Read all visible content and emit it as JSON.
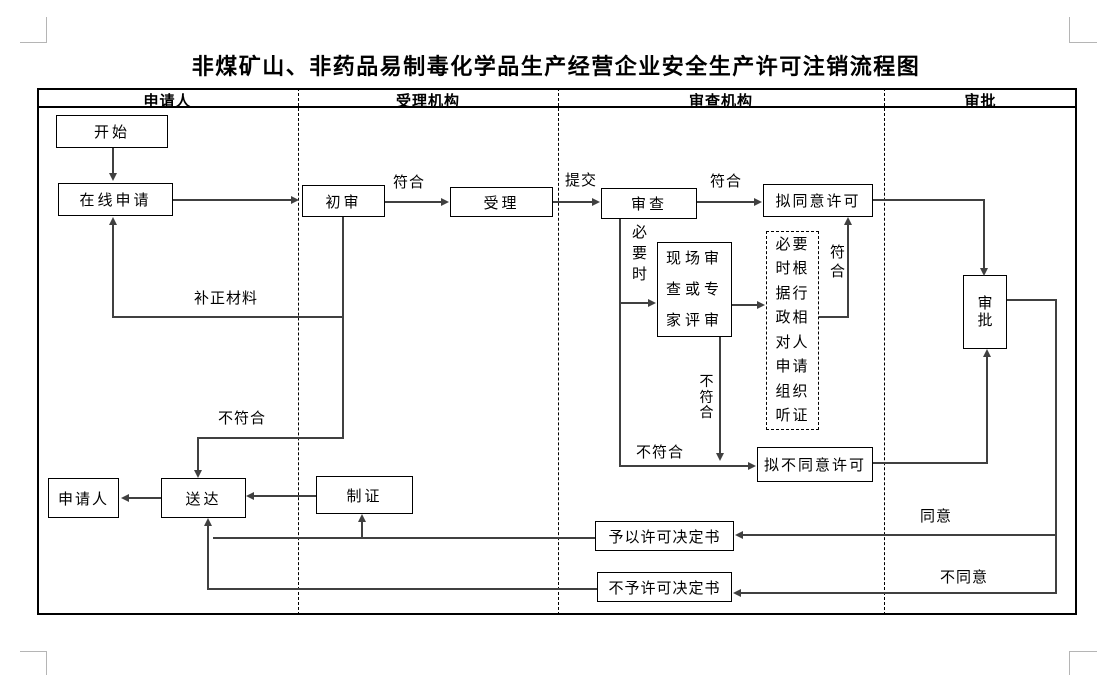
{
  "title": "非煤矿山、非药品易制毒化学品生产经营企业安全生产许可注销流程图",
  "lanes": [
    "申请人",
    "受理机构",
    "审查机构",
    "审批"
  ],
  "nodes": {
    "start": "开始",
    "online_application": "在线申请",
    "initial_review": "初审",
    "acceptance": "受理",
    "review": "审查",
    "onsite_review": "现场审查或专家评审",
    "hearing": "必要时根据行政相对人申请组织听证",
    "propose_approval": "拟同意许可",
    "propose_disapproval": "拟不同意许可",
    "approval": "审批",
    "applicant": "申请人",
    "delivery": "送达",
    "certificate": "制证",
    "grant_decision": "予以许可决定书",
    "deny_decision": "不予许可决定书"
  },
  "edge_labels": {
    "conform_initial": "符合",
    "submit": "提交",
    "conform_review": "符合",
    "supplement_materials": "补正材料",
    "nonconform_initial": "不符合",
    "when_necessary": "必要时",
    "nonconform_onsite": "不符合",
    "conform_hearing": "符合",
    "nonconform_review": "不符合",
    "agree": "同意",
    "disagree": "不同意"
  },
  "colors": {
    "connector": "#404040",
    "box_border": "#000000",
    "background": "#ffffff"
  }
}
